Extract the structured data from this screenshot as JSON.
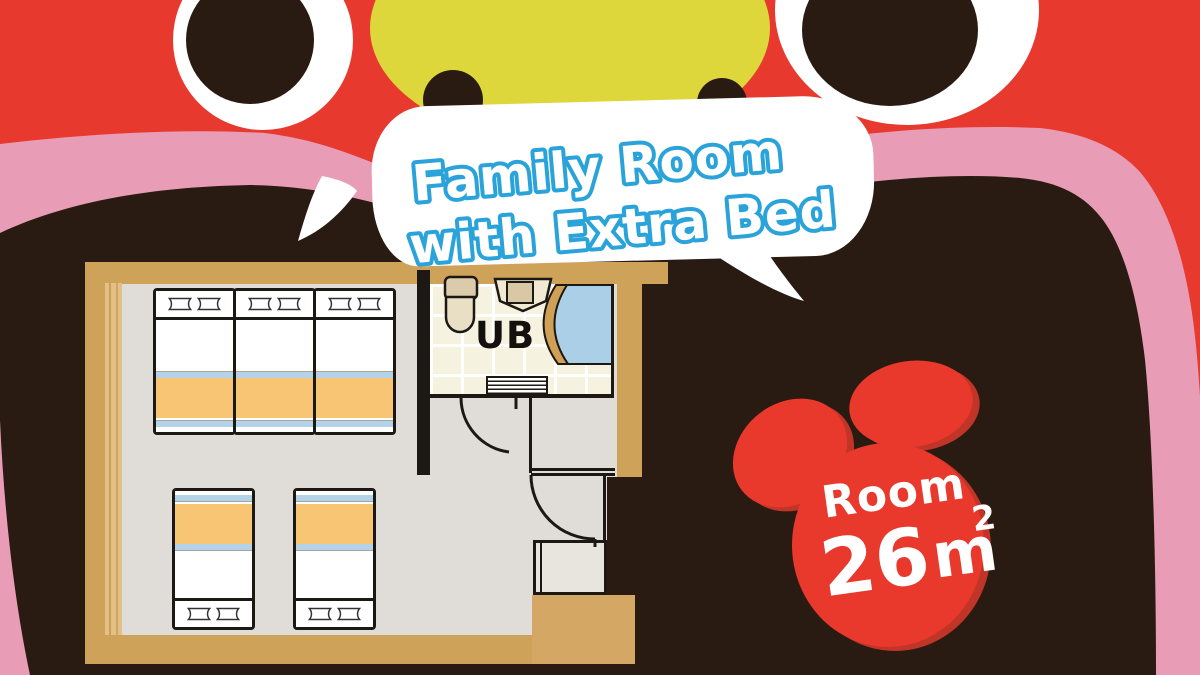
{
  "speech_bubble": {
    "line1": "Family Room",
    "line2": "with Extra Bed"
  },
  "area_badge": {
    "label": "Room",
    "area_value": "26",
    "area_unit": "m",
    "area_exponent": "2"
  },
  "floor_plan": {
    "bath_label": "UB",
    "beds_top_row": 3,
    "beds_bottom_row": 2
  },
  "colors": {
    "background_red": "#e7392d",
    "body_dark_brown": "#2a1b12",
    "blanket_pink": "#e89cb6",
    "mouth_yellow": "#ded73c",
    "bubble_text_blue": "#2aa3da",
    "wall_tan": "#cfa25a",
    "floor_gray": "#e0dcd7",
    "bed_blanket_orange": "#f7c573",
    "bed_sheet_blue": "#b5d3e8",
    "bath_tile_cream": "#f6f2e0",
    "bathtub_blue": "#abcfe6"
  }
}
